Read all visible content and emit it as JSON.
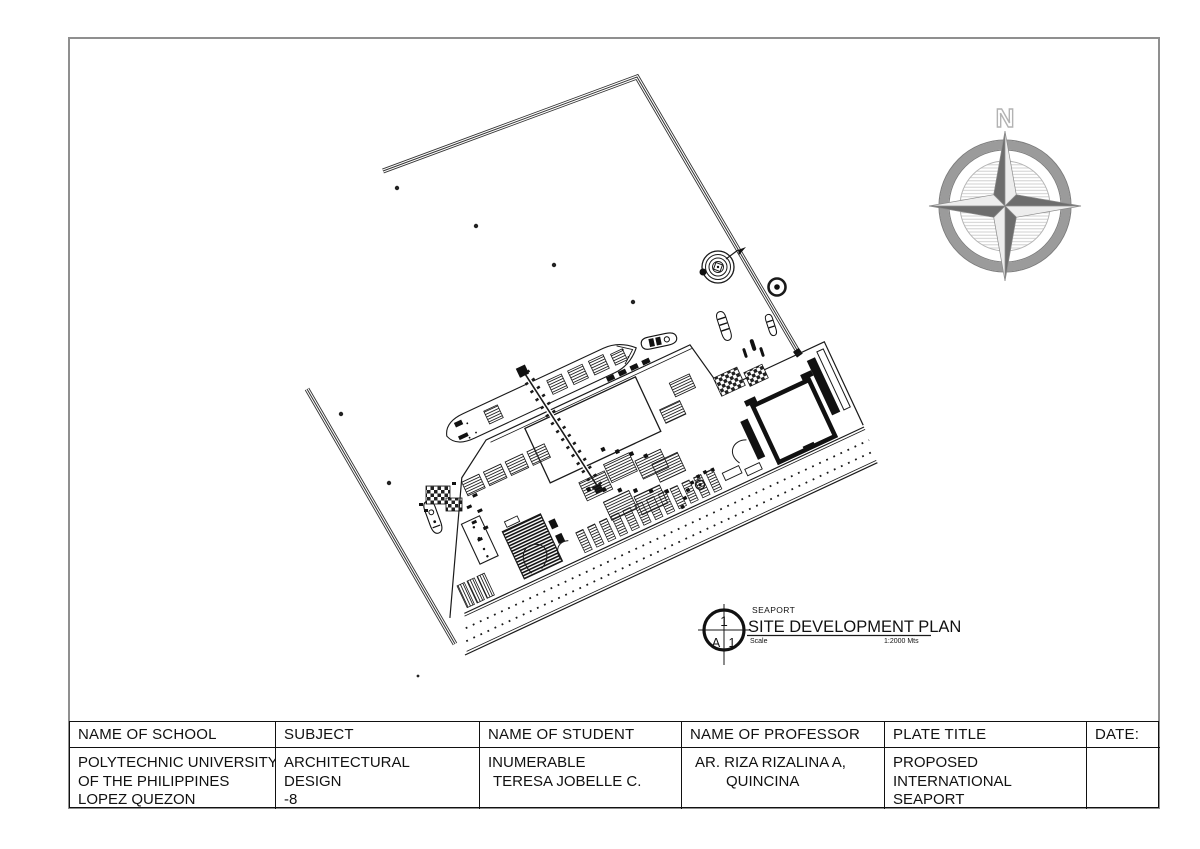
{
  "sheet": {
    "type_label": "architectural plate"
  },
  "compass": {
    "north_label": "N"
  },
  "drawing_label": {
    "detail_number": "1",
    "sheet_letter": "A",
    "sheet_number": "1",
    "supertitle": "SEAPORT",
    "title": "SITE DEVELOPMENT PLAN",
    "scale_label": "Scale",
    "scale_value": "1:2000 Mts"
  },
  "title_block": {
    "columns": [
      {
        "header": "NAME OF SCHOOL",
        "value_lines": [
          "POLYTECHNIC UNIVERSITY",
          "OF THE PHILIPPINES",
          "LOPEZ QUEZON"
        ]
      },
      {
        "header": "SUBJECT",
        "value_lines": [
          "ARCHITECTURAL",
          "DESIGN",
          "-8"
        ]
      },
      {
        "header": "NAME OF STUDENT",
        "value_lines": [
          "INUMERABLE",
          "TERESA JOBELLE C."
        ]
      },
      {
        "header": "NAME OF PROFESSOR",
        "value_lines": [
          "AR. RIZA RIZALINA A,",
          "QUINCINA"
        ]
      },
      {
        "header": "PLATE TITLE",
        "value_lines": [
          "PROPOSED",
          "INTERNATIONAL",
          "SEAPORT"
        ]
      },
      {
        "header": "DATE:",
        "value_lines": []
      }
    ]
  },
  "colors": {
    "drawing_line": "#1a1a1a",
    "page_border": "#8f8f8f",
    "compass_ring": "#9b9b9b",
    "compass_star_dark": "#6d6d6d",
    "compass_star_light": "#ededed",
    "paper": "#ffffff"
  }
}
